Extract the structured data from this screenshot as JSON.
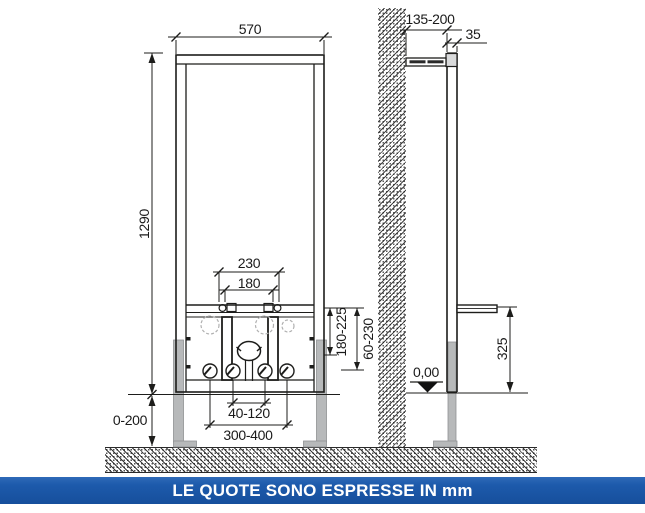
{
  "title": "installation dimensional drawing",
  "units_banner": {
    "text": "LE QUOTE SONO ESPRESSE IN mm",
    "bg": "#1d5aab",
    "fg": "#ffffff"
  },
  "views": {
    "front": {
      "dims": {
        "frame_width": "570",
        "frame_height": "1290",
        "fixings_outer_spacing": "230",
        "fixings_inner_spacing": "180",
        "drain_height_range": "180-225",
        "inlet_height_range": "60-230",
        "leg_adjust_range": "0-200",
        "inlet_span_range": "40-120",
        "anchor_span_range": "300-400"
      }
    },
    "side": {
      "dims": {
        "wall_offset_range": "135-200",
        "rail_depth": "35",
        "support_height": "325",
        "floor_level": "0,00"
      }
    }
  },
  "colors": {
    "line": "#1d1d1b",
    "leg_gray": "#b7b9ba",
    "clamp_gray": "#d9dadb",
    "ghost_gray": "#b0b0b0",
    "banner_blue": "#1d5aab",
    "banner_text": "#ffffff"
  }
}
